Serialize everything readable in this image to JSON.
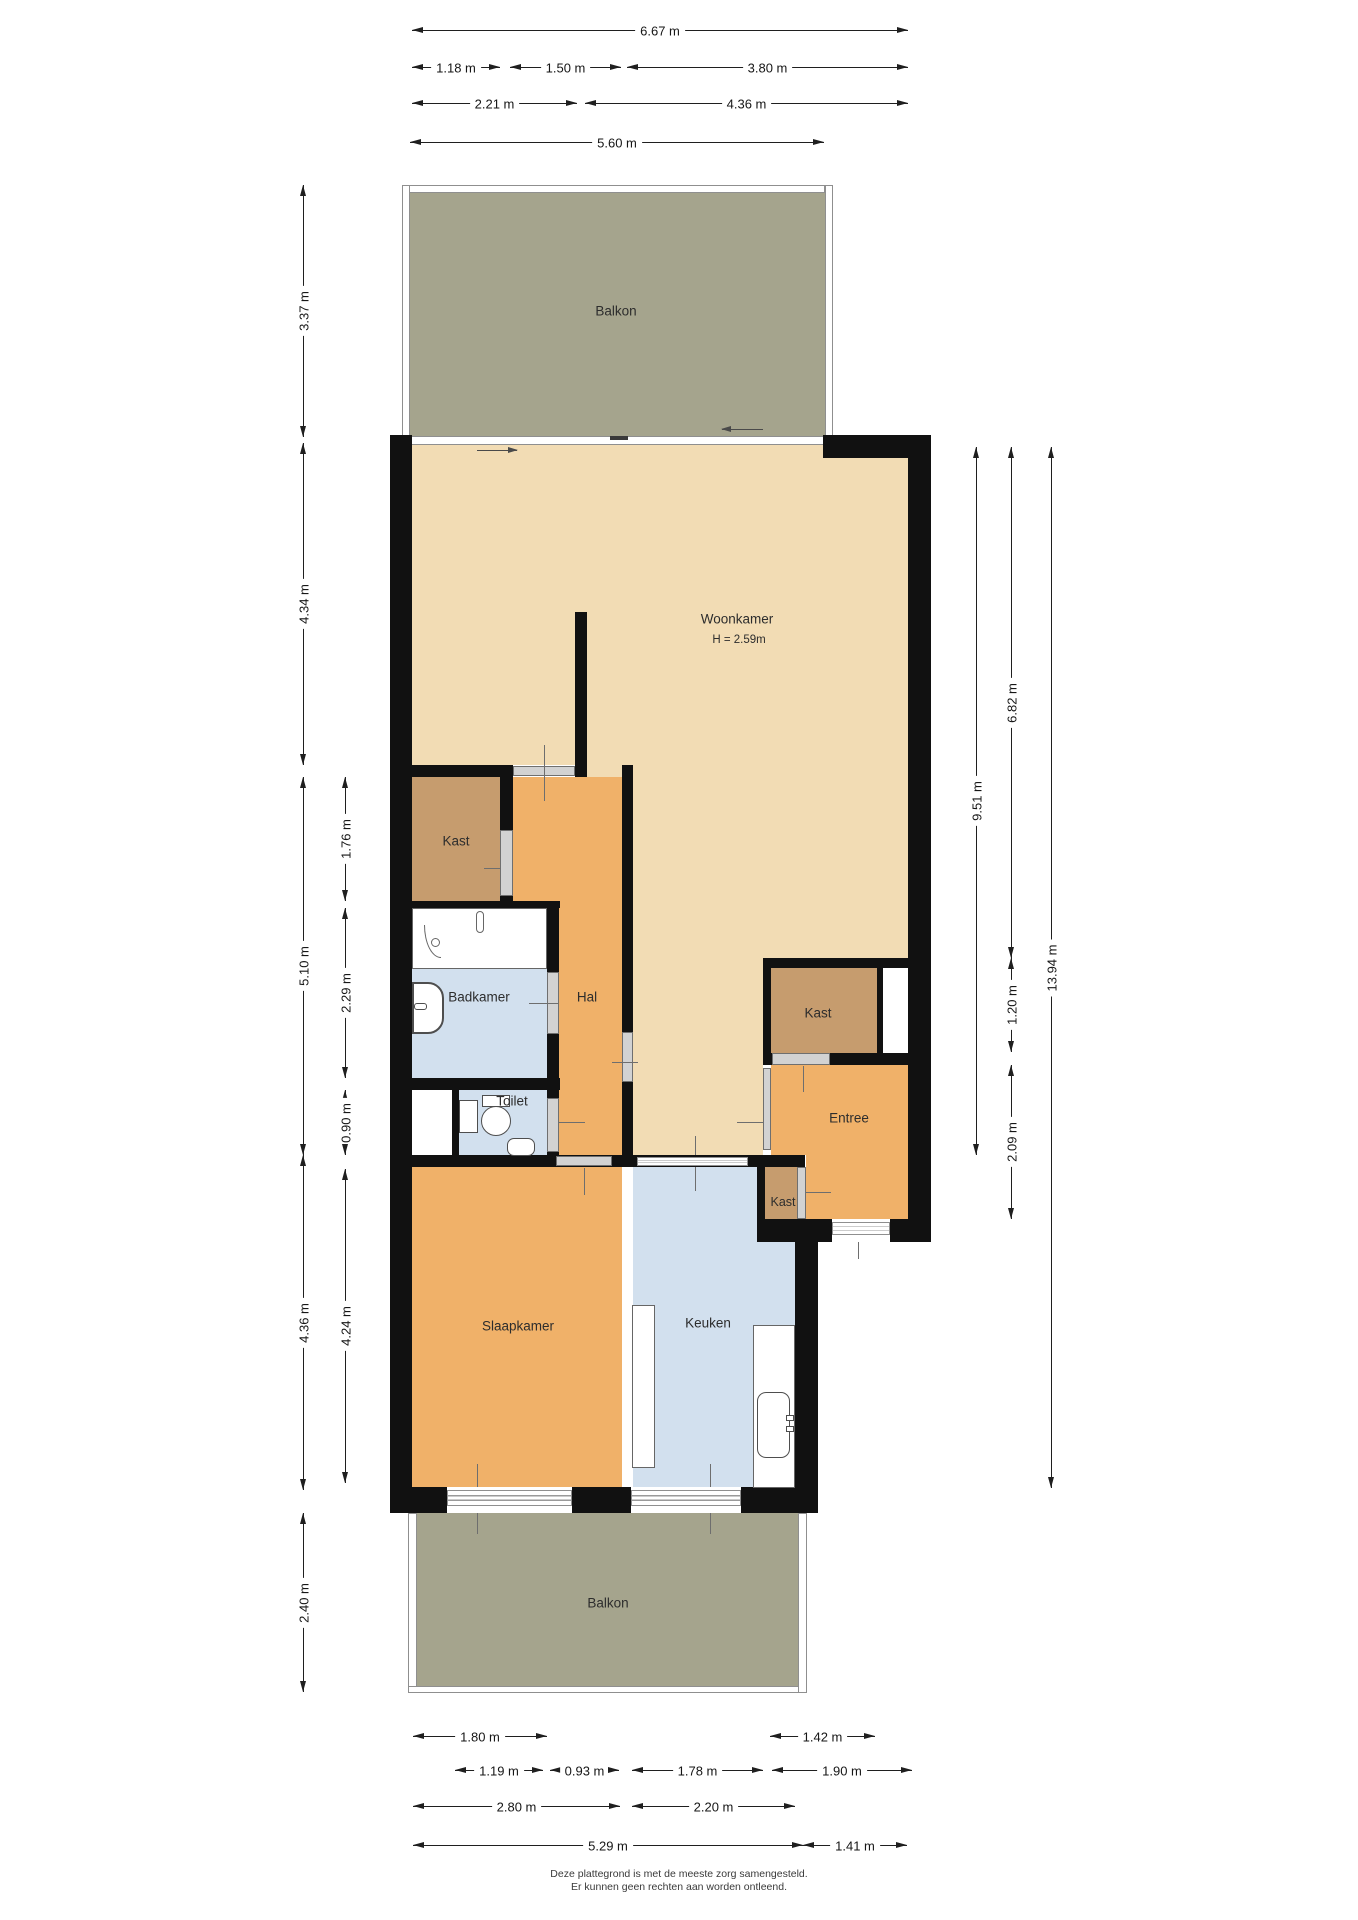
{
  "plan": {
    "rooms": {
      "balkon_top": {
        "label": "Balkon"
      },
      "woonkamer": {
        "label": "Woonkamer",
        "height_note": "H = 2.59m"
      },
      "kast_left": {
        "label": "Kast"
      },
      "hal": {
        "label": "Hal"
      },
      "badkamer": {
        "label": "Badkamer"
      },
      "toilet": {
        "label": "Toilet"
      },
      "kast_right": {
        "label": "Kast"
      },
      "entree": {
        "label": "Entree"
      },
      "kast_entree": {
        "label": "Kast"
      },
      "slaapkamer": {
        "label": "Slaapkamer"
      },
      "keuken": {
        "label": "Keuken"
      },
      "balkon_bottom": {
        "label": "Balkon"
      }
    },
    "colors": {
      "wall": "#111111",
      "line": "#1f1f1f",
      "living": "#f2dcb4",
      "orange": "#f0b169",
      "closet": "#c69c6e",
      "wet": "#d2e0ee",
      "balcony": "#a5a48d",
      "door": "#d2d2d2"
    },
    "dimensions": [
      {
        "o": "h",
        "a": 412,
        "b": 908,
        "p": 30,
        "label": "6.67 m"
      },
      {
        "o": "h",
        "a": 412,
        "b": 500,
        "p": 67,
        "label": "1.18 m"
      },
      {
        "o": "h",
        "a": 510,
        "b": 621,
        "p": 67,
        "label": "1.50 m"
      },
      {
        "o": "h",
        "a": 627,
        "b": 908,
        "p": 67,
        "label": "3.80 m"
      },
      {
        "o": "h",
        "a": 412,
        "b": 577,
        "p": 103,
        "label": "2.21 m"
      },
      {
        "o": "h",
        "a": 585,
        "b": 908,
        "p": 103,
        "label": "4.36 m"
      },
      {
        "o": "h",
        "a": 410,
        "b": 824,
        "p": 142,
        "label": "5.60 m"
      },
      {
        "o": "v",
        "a": 185,
        "b": 437,
        "p": 303,
        "label": "3.37 m"
      },
      {
        "o": "v",
        "a": 443,
        "b": 765,
        "p": 303,
        "label": "4.34 m"
      },
      {
        "o": "v",
        "a": 777,
        "b": 1155,
        "p": 303,
        "label": "5.10 m"
      },
      {
        "o": "v",
        "a": 1155,
        "b": 1490,
        "p": 303,
        "label": "4.36 m"
      },
      {
        "o": "v",
        "a": 1513,
        "b": 1692,
        "p": 303,
        "label": "2.40 m"
      },
      {
        "o": "v",
        "a": 777,
        "b": 901,
        "p": 345,
        "label": "1.76 m"
      },
      {
        "o": "v",
        "a": 908,
        "b": 1078,
        "p": 345,
        "label": "2.29 m"
      },
      {
        "o": "v",
        "a": 1090,
        "b": 1155,
        "p": 345,
        "label": "0.90 m"
      },
      {
        "o": "v",
        "a": 1169,
        "b": 1483,
        "p": 345,
        "label": "4.24 m"
      },
      {
        "o": "v",
        "a": 447,
        "b": 1155,
        "p": 976,
        "label": "9.51 m"
      },
      {
        "o": "v",
        "a": 447,
        "b": 958,
        "p": 1011,
        "label": "6.82 m"
      },
      {
        "o": "v",
        "a": 958,
        "b": 1052,
        "p": 1011,
        "label": "1.20 m"
      },
      {
        "o": "v",
        "a": 1065,
        "b": 1219,
        "p": 1011,
        "label": "2.09 m"
      },
      {
        "o": "v",
        "a": 447,
        "b": 1488,
        "p": 1051,
        "label": "13.94 m"
      },
      {
        "o": "h",
        "a": 413,
        "b": 547,
        "p": 1736,
        "label": "1.80 m"
      },
      {
        "o": "h",
        "a": 770,
        "b": 875,
        "p": 1736,
        "label": "1.42 m"
      },
      {
        "o": "h",
        "a": 455,
        "b": 543,
        "p": 1770,
        "label": "1.19 m"
      },
      {
        "o": "h",
        "a": 550,
        "b": 619,
        "p": 1770,
        "label": "0.93 m"
      },
      {
        "o": "h",
        "a": 632,
        "b": 763,
        "p": 1770,
        "label": "1.78 m"
      },
      {
        "o": "h",
        "a": 772,
        "b": 912,
        "p": 1770,
        "label": "1.90 m"
      },
      {
        "o": "h",
        "a": 413,
        "b": 620,
        "p": 1806,
        "label": "2.80 m"
      },
      {
        "o": "h",
        "a": 632,
        "b": 795,
        "p": 1806,
        "label": "2.20 m"
      },
      {
        "o": "h",
        "a": 413,
        "b": 803,
        "p": 1845,
        "label": "5.29 m"
      },
      {
        "o": "h",
        "a": 803,
        "b": 907,
        "p": 1845,
        "label": "1.41 m"
      }
    ],
    "footer": {
      "line1": "Deze plattegrond is met de meeste zorg samengesteld.",
      "line2": "Er kunnen geen rechten aan worden ontleend."
    }
  }
}
